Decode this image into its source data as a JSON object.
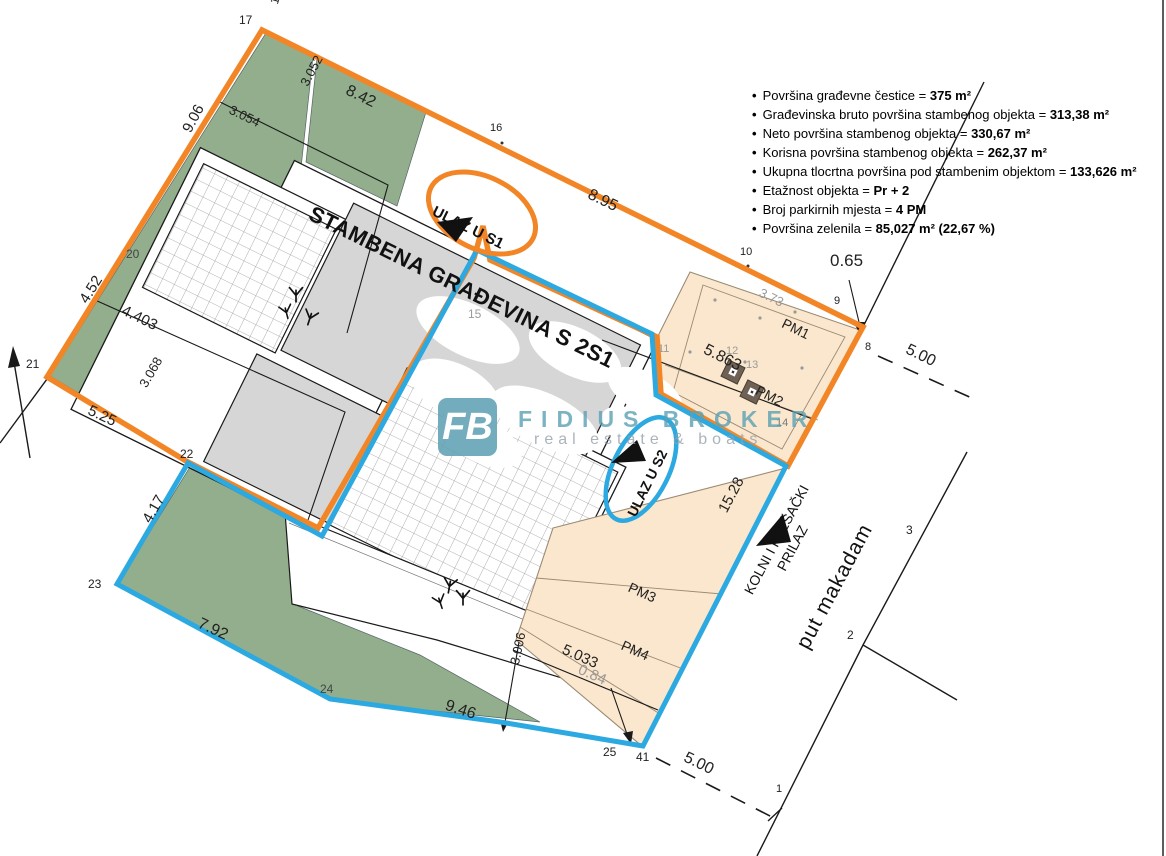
{
  "title": "STAMBENA GRAĐEVINA S 2S1",
  "legend": {
    "items": [
      {
        "label": "Površina građevne čestice =",
        "value": "375 m²"
      },
      {
        "label": "Građevinska bruto površina stambenog objekta =",
        "value": "313,38 m²"
      },
      {
        "label": "Neto površina stambenog objekta =",
        "value": "330,67 m²"
      },
      {
        "label": "Korisna površina stambenog objekta =",
        "value": "262,37 m²"
      },
      {
        "label": "Ukupna tlocrtna površina pod stambenim objektom =",
        "value": "133,626 m²"
      },
      {
        "label": "Etažnost objekta =",
        "value": "Pr + 2"
      },
      {
        "label": "Broj parkirnih mjesta =",
        "value": "4 PM"
      },
      {
        "label": "Površina zelenila =",
        "value": "85,027 m² (22,67 %)"
      }
    ]
  },
  "entrances": {
    "s1": "ULAZ U S1",
    "s2": "ULAZ U S2"
  },
  "roads": {
    "kolni_line1": "KOLNI I PJEŠAČKI",
    "kolni_line2": "PRILAZ",
    "put": "put makadam"
  },
  "watermark": {
    "logo": "FB",
    "name": "FIDIUS BROKER",
    "tagline": "real estate & boats"
  },
  "colors": {
    "orange": "#F28627",
    "blue": "#2BA9E0",
    "green": "#92AE8C",
    "peach": "#FAE7CD",
    "peach_border": "#9B8B74",
    "roof_gray": "#D6D6D6",
    "teal": "#64A9BD",
    "line": "#1A1A1A",
    "dim_gray": "#9A9A9A"
  },
  "labels": [
    {
      "text": "17",
      "x": 239,
      "y": 14,
      "rot": 0,
      "size": 12
    },
    {
      "text": "1.46",
      "x": 268,
      "y": 2,
      "rot": -73,
      "size": 12
    },
    {
      "text": "8.42",
      "x": 350,
      "y": 83,
      "rot": 26,
      "size": 16
    },
    {
      "text": "3.052",
      "x": 298,
      "y": 82,
      "rot": -62,
      "size": 13
    },
    {
      "text": "3.054",
      "x": 233,
      "y": 103,
      "rot": 26,
      "size": 13
    },
    {
      "text": "9.06",
      "x": 180,
      "y": 128,
      "rot": -62,
      "size": 15
    },
    {
      "text": "16",
      "x": 490,
      "y": 123,
      "rot": 0,
      "size": 11
    },
    {
      "text": "8.95",
      "x": 592,
      "y": 187,
      "rot": 26,
      "size": 16
    },
    {
      "text": "10",
      "x": 740,
      "y": 247,
      "rot": 0,
      "size": 11
    },
    {
      "text": "0.65",
      "x": 830,
      "y": 252,
      "rot": 0,
      "size": 17
    },
    {
      "text": "9",
      "x": 834,
      "y": 296,
      "rot": 0,
      "size": 11
    },
    {
      "text": "8",
      "x": 865,
      "y": 342,
      "rot": 0,
      "size": 11
    },
    {
      "text": "5.00",
      "x": 910,
      "y": 342,
      "rot": 26,
      "size": 16
    },
    {
      "text": "3.73",
      "x": 763,
      "y": 286,
      "rot": 26,
      "size": 13,
      "color": "#9a9a9a"
    },
    {
      "text": "PM1",
      "x": 786,
      "y": 316,
      "rot": 26,
      "size": 14
    },
    {
      "text": "11",
      "x": 658,
      "y": 344,
      "rot": 0,
      "size": 11,
      "color": "#9a9a9a"
    },
    {
      "text": "12",
      "x": 726,
      "y": 346,
      "rot": 0,
      "size": 11,
      "color": "#9a9a9a"
    },
    {
      "text": "13",
      "x": 746,
      "y": 360,
      "rot": 0,
      "size": 11,
      "color": "#9a9a9a"
    },
    {
      "text": "5.863",
      "x": 708,
      "y": 342,
      "rot": 27,
      "size": 16
    },
    {
      "text": "PM2",
      "x": 760,
      "y": 383,
      "rot": 27,
      "size": 14
    },
    {
      "text": "14",
      "x": 776,
      "y": 418,
      "rot": 0,
      "size": 11,
      "color": "#777"
    },
    {
      "text": "15",
      "x": 468,
      "y": 308,
      "rot": 0,
      "size": 12,
      "color": "#9a9a9a"
    },
    {
      "text": "20",
      "x": 126,
      "y": 248,
      "rot": 0,
      "size": 12,
      "color": "#444"
    },
    {
      "text": "4.52",
      "x": 77,
      "y": 298,
      "rot": -58,
      "size": 15
    },
    {
      "text": "4.403",
      "x": 126,
      "y": 303,
      "rot": 26,
      "size": 15
    },
    {
      "text": "3.068",
      "x": 137,
      "y": 383,
      "rot": -60,
      "size": 13
    },
    {
      "text": "5.25",
      "x": 92,
      "y": 403,
      "rot": 25,
      "size": 15
    },
    {
      "text": "21",
      "x": 26,
      "y": 358,
      "rot": 0,
      "size": 12
    },
    {
      "text": "22",
      "x": 180,
      "y": 448,
      "rot": 0,
      "size": 12
    },
    {
      "text": "23",
      "x": 88,
      "y": 578,
      "rot": 0,
      "size": 12
    },
    {
      "text": "4.17",
      "x": 140,
      "y": 518,
      "rot": -60,
      "size": 15
    },
    {
      "text": "7.92",
      "x": 202,
      "y": 616,
      "rot": 25,
      "size": 16
    },
    {
      "text": "24",
      "x": 320,
      "y": 683,
      "rot": 0,
      "size": 12,
      "color": "#444"
    },
    {
      "text": "9.46",
      "x": 448,
      "y": 698,
      "rot": 18,
      "size": 16
    },
    {
      "text": "3.006",
      "x": 508,
      "y": 663,
      "rot": -78,
      "size": 13
    },
    {
      "text": "5.033",
      "x": 566,
      "y": 642,
      "rot": 24,
      "size": 15
    },
    {
      "text": "0.84",
      "x": 582,
      "y": 662,
      "rot": 24,
      "size": 15,
      "color": "#9a9a9a"
    },
    {
      "text": "PM3",
      "x": 632,
      "y": 580,
      "rot": 24,
      "size": 14
    },
    {
      "text": "PM4",
      "x": 625,
      "y": 638,
      "rot": 24,
      "size": 14
    },
    {
      "text": "25",
      "x": 603,
      "y": 746,
      "rot": 0,
      "size": 12
    },
    {
      "text": "41",
      "x": 636,
      "y": 751,
      "rot": 0,
      "size": 12
    },
    {
      "text": "5.00",
      "x": 688,
      "y": 750,
      "rot": 26,
      "size": 16
    },
    {
      "text": "1",
      "x": 776,
      "y": 784,
      "rot": 0,
      "size": 11
    },
    {
      "text": "2",
      "x": 847,
      "y": 629,
      "rot": 0,
      "size": 12
    },
    {
      "text": "3",
      "x": 906,
      "y": 524,
      "rot": 0,
      "size": 12
    },
    {
      "text": "15.28",
      "x": 716,
      "y": 508,
      "rot": -62,
      "size": 15
    }
  ]
}
